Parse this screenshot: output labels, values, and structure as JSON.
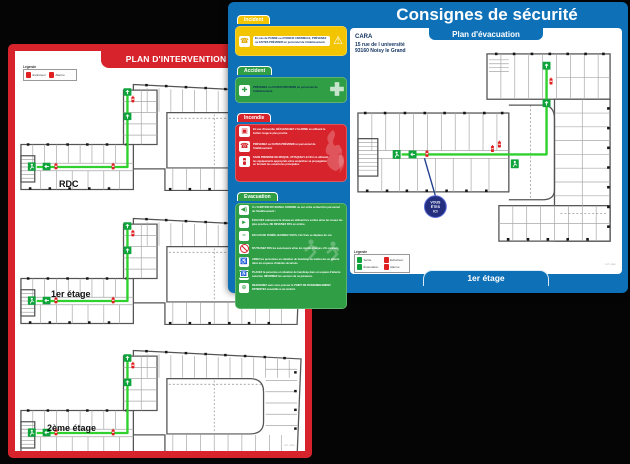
{
  "colors": {
    "blue": "#0e71b8",
    "red": "#d7242c",
    "yellow": "#f3c400",
    "green": "#2f9e44",
    "navy": "#10305f",
    "route_green": "#2fd12f",
    "badge_navy": "#232f7e"
  },
  "red_poster": {
    "title": "PLAN D'INTERVENTION",
    "legend": {
      "title": "Légende",
      "item1": "Extincteur",
      "item2": "Alarme"
    },
    "floor1": "RDC",
    "floor2": "1er étage",
    "floor3": "2ème étage",
    "ref": "réf. plan"
  },
  "blue_poster": {
    "title": "Consignes de sécurité",
    "subtitle": "Plan d'évacuation",
    "address1": "CARA",
    "address2": "15 rue de l université",
    "address3": "93160 Noisy le Grand",
    "floor_label": "1er étage",
    "badge1": "VOUS",
    "badge2": "ÊTES",
    "badge3": "ICI",
    "legend": {
      "title": "Légende",
      "item1": "Sortie",
      "item2": "Extincteur",
      "item3": "Évacuation",
      "item4": "Alarme"
    },
    "ref": "réf. plan"
  },
  "panel": {
    "incident": {
      "title": "Incident",
      "text": "En cas de PANNE ou d'ODEUR ANORMALE, PRÉVENEZ ou FAITES PRÉVENIR un personnel de l'établissement."
    },
    "accident": {
      "title": "Accident",
      "text": "PRÉVENEZ ou FAITES PRÉVENIR un personnel de l'établissement."
    },
    "incendie": {
      "title": "Incendie",
      "item1": "En cas d'incendie, DÉCLENCHEZ L'ALARME en utilisant le boîtier rouge le plus proche.",
      "item2": "PRÉVENEZ ou FAITES PRÉVENIR un personnel de l'établissement.",
      "item3": "SANS PRENDRE DE RISQUE, ATTAQUEZ LE FEU en utilisant les équipements appropriés et/ou empêchez sa propagation en fermant les ouvertures principales."
    },
    "evacuation": {
      "title": "Evacuation",
      "item1": "À L'AUDITION DU SIGNAL SONORE ou sur ordre verbal d'un personnel de l'établissement :",
      "item2": "ÉVACUEZ calmement le niveau en utilisant les sorties et/ou les issues les plus proches, NE REVENEZ PAS en arrière.",
      "item3": "EN CAS DE FUMÉE, BAISSEZ-VOUS, l'air frais se déplace du sol.",
      "item4": "N'UTILISEZ PAS les ascenseurs et/ou les monte-charges s'ils existent.",
      "item5": "AIDEZ les personnes en situation de handicap ou mettez-les en attente dans les espaces d'attente sécurisés.",
      "item6": "PLACEZ la personne en situation de handicap dans un espace d'attente sécurisé, INFORMEZ les secours de sa présence.",
      "item7": "REJOIGNEZ sans vous presser le POINT DE RASSEMBLEMENT, PATIENTEZ ensemble à cet endroit."
    }
  }
}
